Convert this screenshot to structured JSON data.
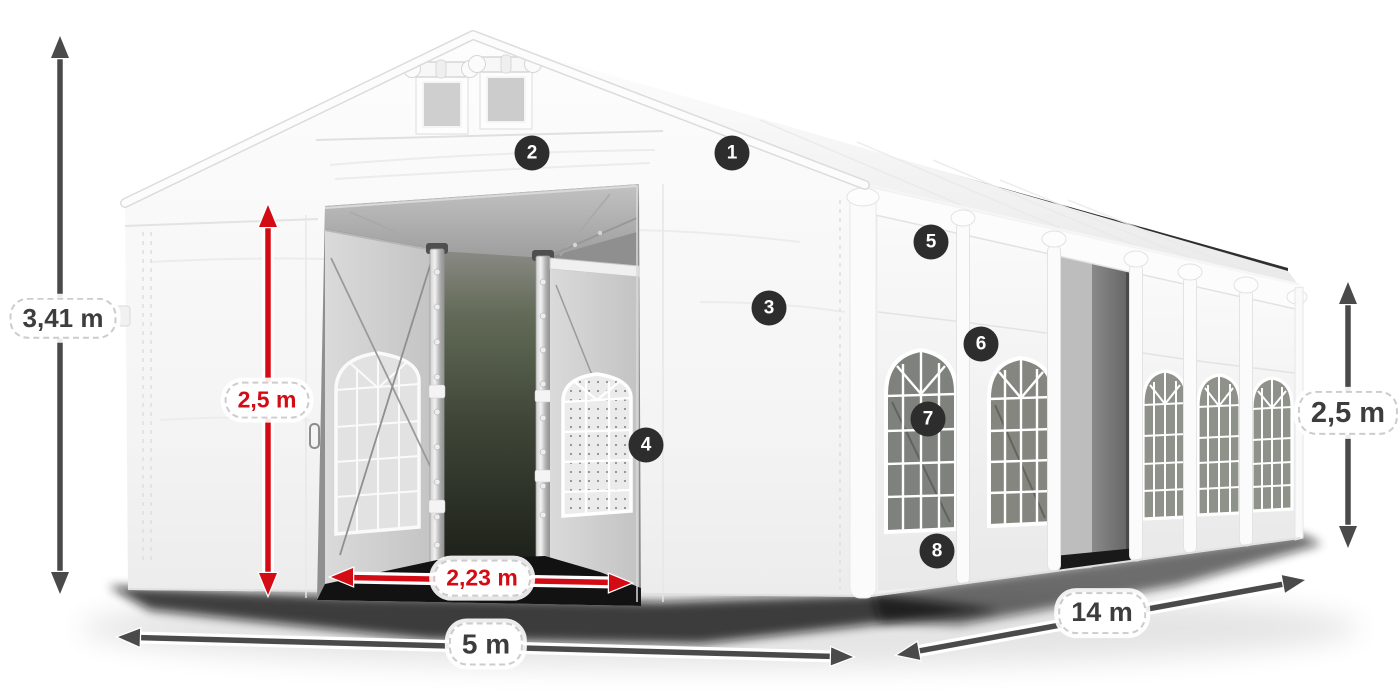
{
  "diagram": {
    "labels": {
      "total_height": "3,41 m",
      "entrance_height": "2,5 m",
      "entrance_width": "2,23 m",
      "front_width": "5 m",
      "side_length": "14 m",
      "side_height": "2,5 m"
    },
    "callouts": [
      {
        "number": "1"
      },
      {
        "number": "2"
      },
      {
        "number": "3"
      },
      {
        "number": "4"
      },
      {
        "number": "5"
      },
      {
        "number": "6"
      },
      {
        "number": "7"
      },
      {
        "number": "8"
      }
    ],
    "colors": {
      "background": "#ffffff",
      "dimension_red": "#d30b14",
      "dimension_gray": "#4a4a4a",
      "badge_background": "#2d2d2d",
      "badge_text": "#ffffff"
    }
  }
}
